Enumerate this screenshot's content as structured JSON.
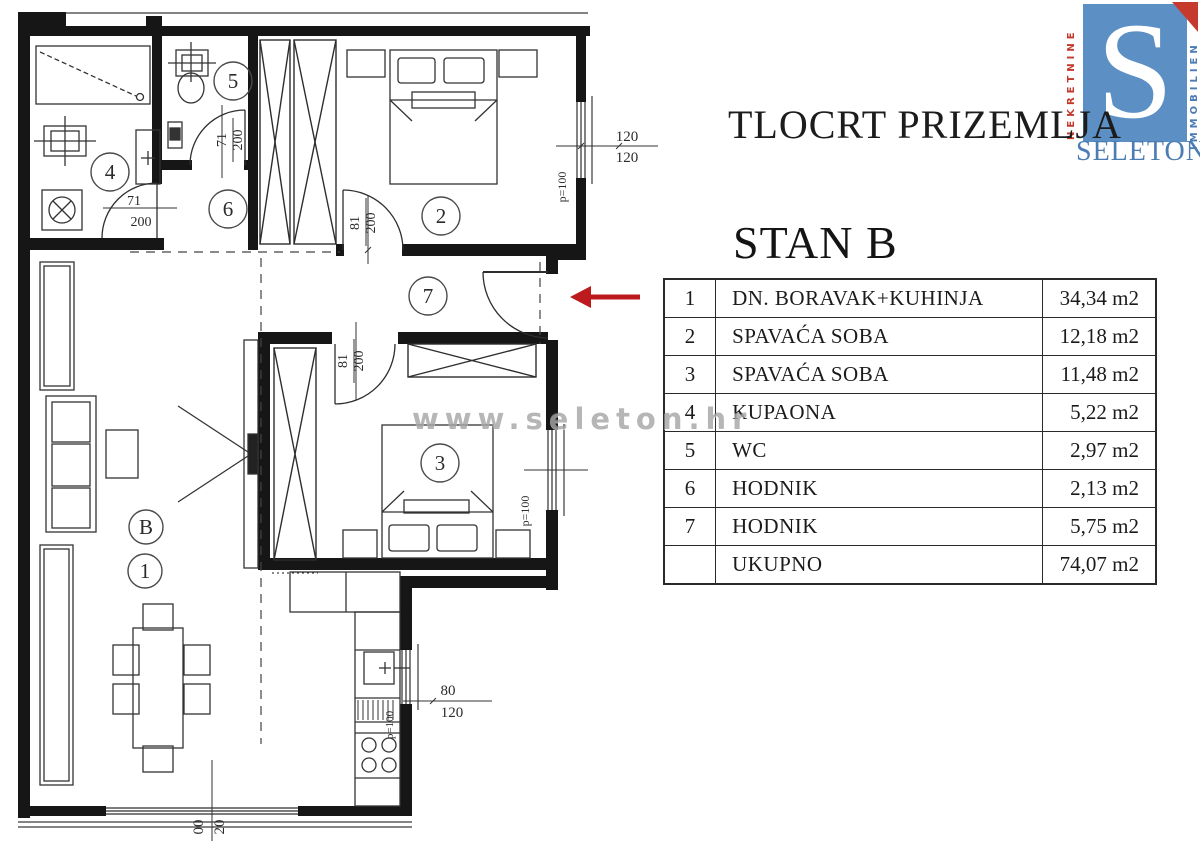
{
  "header": {
    "title": "TLOCRT PRIZEMLJA",
    "unit_title": "STAN B"
  },
  "watermark": "www.seleton.hr",
  "logo": {
    "letter": "S",
    "brand": "SELETON",
    "left_text": "NEKRETNINE",
    "right_text": "IMMOBILIEN",
    "blue": "#5c90c5",
    "red": "#c5372b"
  },
  "arrow_color": "#bc1a1d",
  "area_table": {
    "rows": [
      {
        "num": "1",
        "name": "DN. BORAVAK+KUHINJA",
        "area": "34,34 m2"
      },
      {
        "num": "2",
        "name": "SPAVAĆA SOBA",
        "area": "12,18 m2"
      },
      {
        "num": "3",
        "name": "SPAVAĆA SOBA",
        "area": "11,48 m2"
      },
      {
        "num": "4",
        "name": "KUPAONA",
        "area": "5,22 m2"
      },
      {
        "num": "5",
        "name": "WC",
        "area": "2,97 m2"
      },
      {
        "num": "6",
        "name": "HODNIK",
        "area": "2,13 m2"
      },
      {
        "num": "7",
        "name": "HODNIK",
        "area": "5,75 m2"
      },
      {
        "num": "",
        "name": "UKUPNO",
        "area": "74,07 m2"
      }
    ]
  },
  "plan": {
    "room_markers": [
      {
        "label": "4"
      },
      {
        "label": "5"
      },
      {
        "label": "6"
      },
      {
        "label": "2"
      },
      {
        "label": "7"
      },
      {
        "label": "3"
      },
      {
        "label": "B"
      },
      {
        "label": "1"
      }
    ],
    "dimensions": {
      "win2_top": "120",
      "win2_bot": "120",
      "win2_p": "p=100",
      "door2_w": "81",
      "door2_h": "200",
      "door4_w": "71",
      "door4_h": "200",
      "door5_w": "71",
      "door5_h": "200",
      "door3_w": "81",
      "door3_h": "200",
      "win3_p": "p=100",
      "wink_w": "80",
      "wink_h": "120",
      "wink_p": "p=100",
      "winb_a": "00",
      "winb_b": "20"
    }
  }
}
